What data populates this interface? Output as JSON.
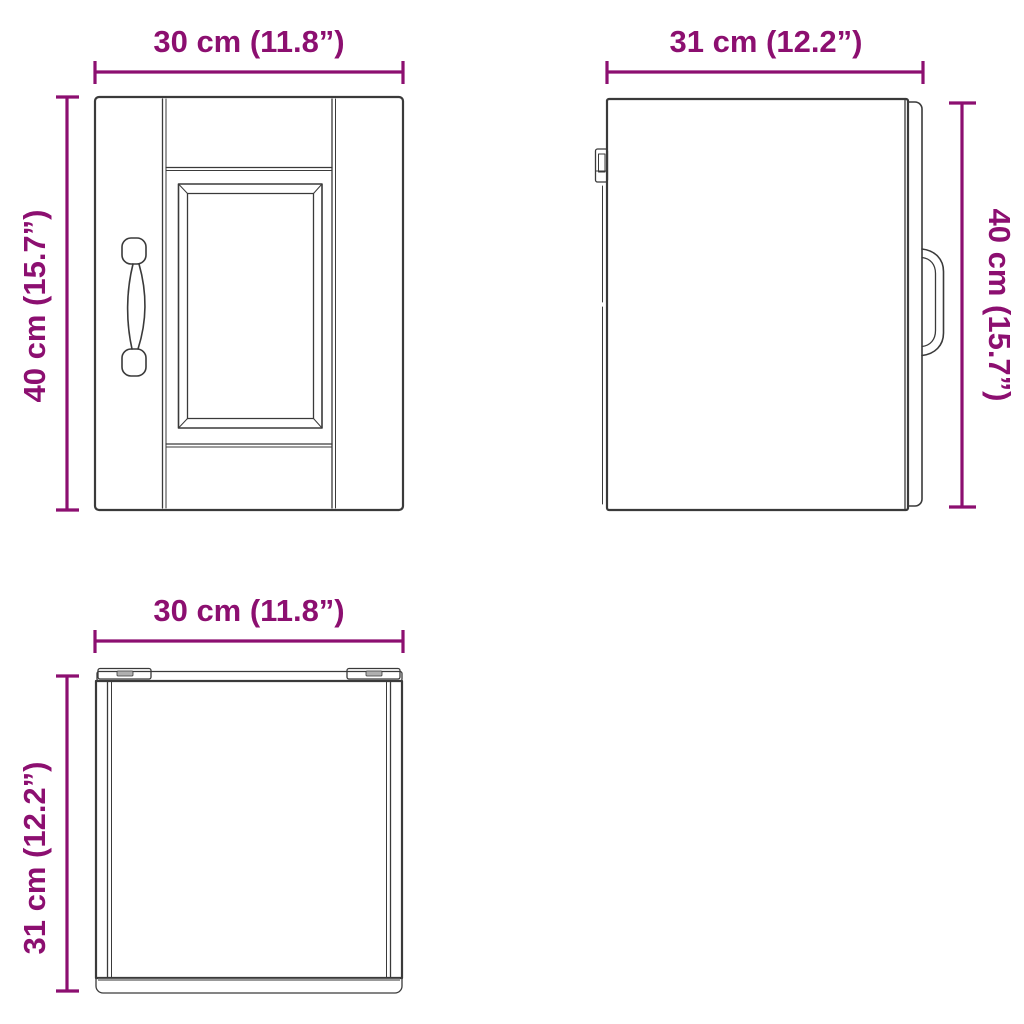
{
  "diagram": {
    "type": "product-dimension-diagram",
    "subject": "wall-cabinet-three-views",
    "background_color": "#ffffff",
    "accent_color": "#8C0F70",
    "line_color": "#3A3A3A",
    "views": {
      "front": {
        "width_label": "30 cm (11.8”)",
        "height_label": "40 cm (15.7”)"
      },
      "side": {
        "width_label": "31 cm (12.2”)",
        "height_label": "40 cm (15.7”)"
      },
      "top": {
        "width_label": "30 cm (11.8”)",
        "depth_label": "31 cm (12.2”)"
      }
    },
    "dimensions": {
      "width": {
        "cm": 30,
        "in": 11.8
      },
      "depth": {
        "cm": 31,
        "in": 12.2
      },
      "height": {
        "cm": 40,
        "in": 15.7
      }
    }
  }
}
